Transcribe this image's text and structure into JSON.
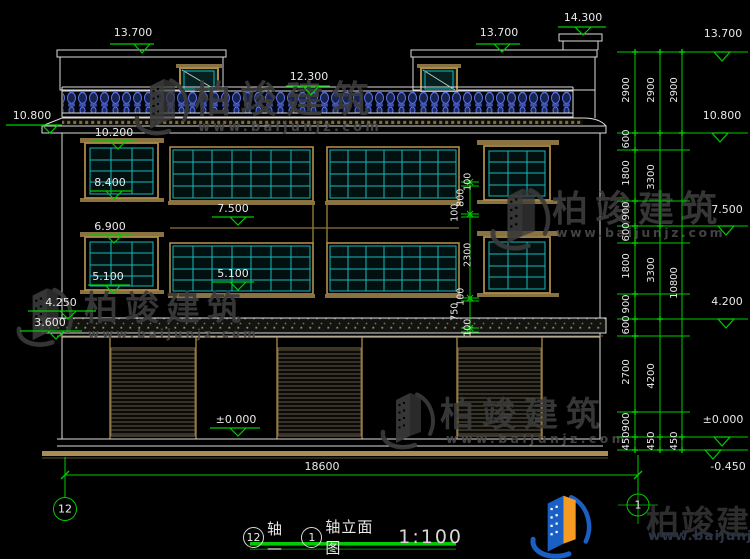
{
  "drawing_title": {
    "bubble_left": "12",
    "seg1": "轴—",
    "bubble_right": "1",
    "seg2": "轴立面图",
    "scale": "1:100"
  },
  "levels": {
    "l14300": "14.300",
    "l13700": "13.700",
    "l12300": "12.300",
    "l10800": "10.800",
    "l10200": "10.200",
    "l8400": "8.400",
    "l7500": "7.500",
    "l6900": "6.900",
    "l5100": "5.100",
    "l4250": "4.250",
    "l4200": "4.200",
    "l3600": "3.600",
    "l0": "±0.000",
    "lm450": "-0.450"
  },
  "dims": {
    "total_width": "18600",
    "window_chain": [
      "100",
      "800",
      "100",
      "2300",
      "100",
      "750",
      "100"
    ],
    "floor_chain": [
      "2900",
      "600",
      "1800",
      "900",
      "600",
      "1800",
      "900",
      "600",
      "2700",
      "900",
      "450"
    ],
    "story_chain": [
      "2900",
      "3300",
      "3300",
      "4200",
      "450"
    ],
    "overall_chain": [
      "2900",
      "10800",
      "450"
    ]
  },
  "watermark": {
    "brand": "柏竣建筑",
    "url": "www.baijunjz.com"
  },
  "logo": {
    "brand": "柏竣建筑",
    "url": "www.baijunjz.com"
  }
}
